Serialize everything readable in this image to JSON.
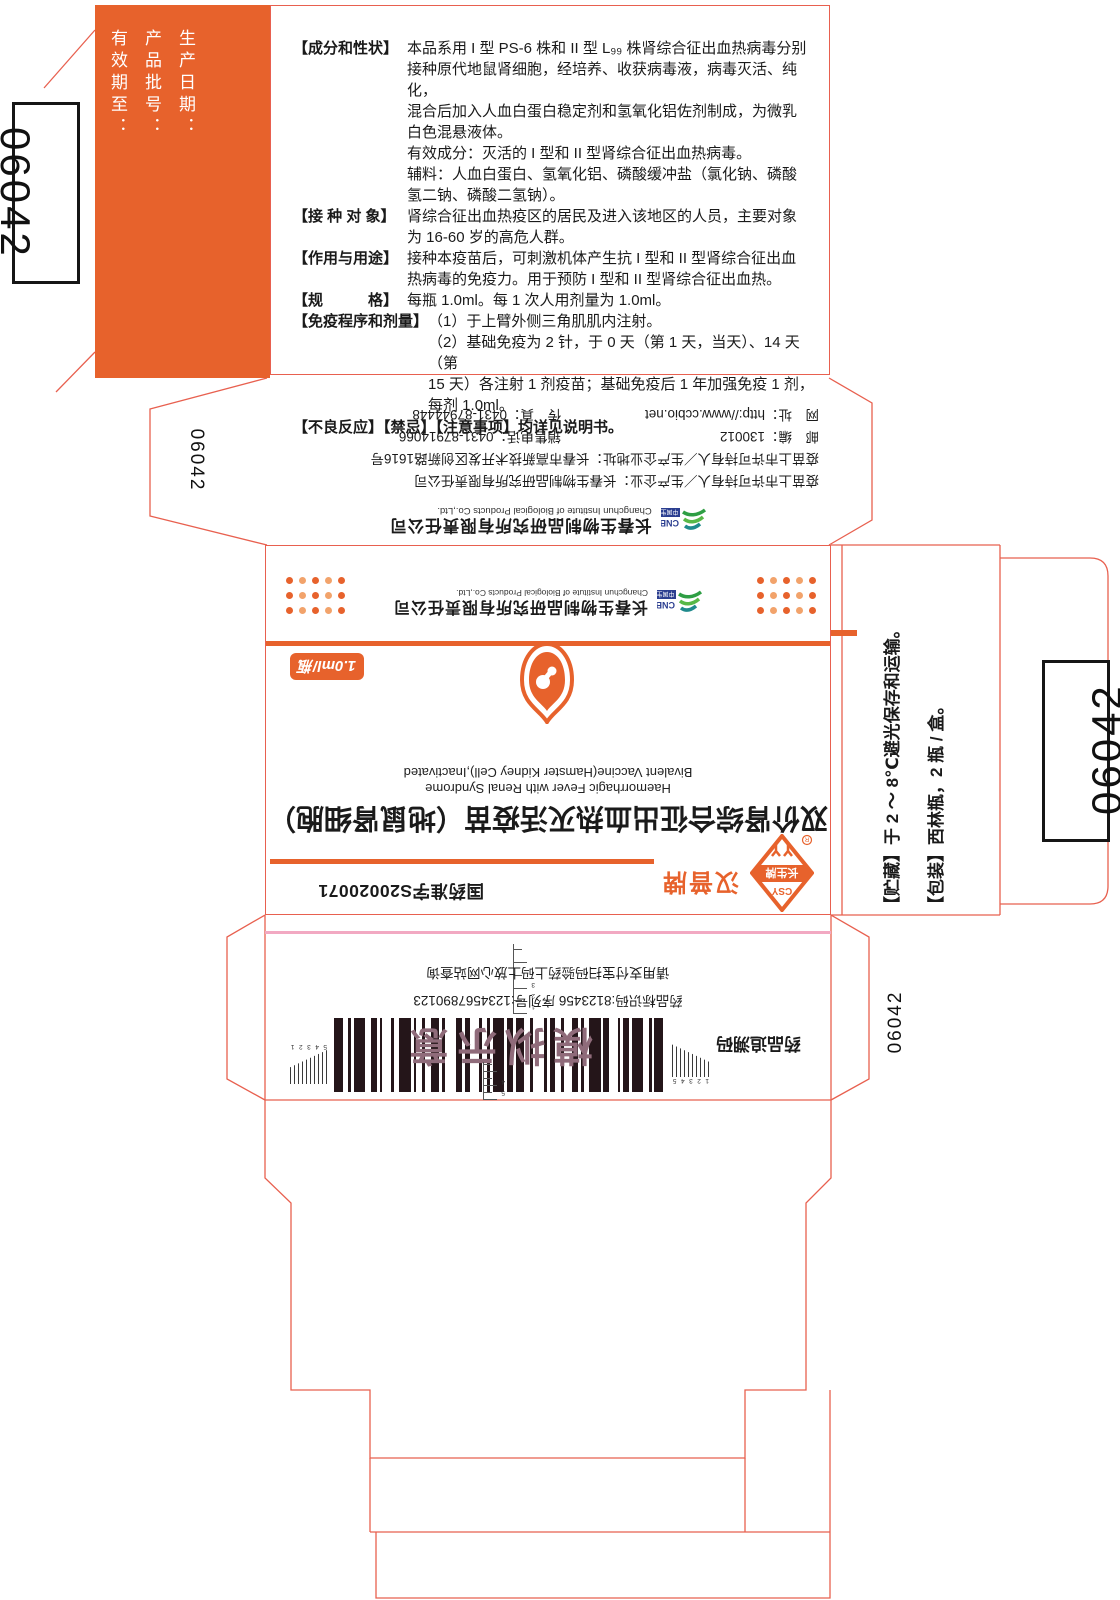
{
  "colors": {
    "orange": "#E7622C",
    "dieline": "#E8604F",
    "pink": "#F2A9C2",
    "mauve": "#8F6B7A",
    "blue": "#2B3E90",
    "green": "#2E9E44"
  },
  "dieline_codes": {
    "left_box": "06042",
    "right_box": "06042",
    "top_flap": "06042",
    "bottom_flap": "06042"
  },
  "batch_panel": {
    "lines": [
      "生产日期：",
      "产品批号：",
      "有效期至："
    ]
  },
  "spec_panel": {
    "sections": [
      {
        "label": "【成分和性状】",
        "text": "本品系用 I 型 PS-6 株和 II 型 L₉₉ 株肾综合征出血热病毒分别\n接种原代地鼠肾细胞，经培养、收获病毒液，病毒灭活、纯化，\n混合后加入人血白蛋白稳定剂和氢氧化铝佐剂制成，为微乳\n白色混悬液体。\n有效成分：灭活的 I 型和 II 型肾综合征出血热病毒。\n辅料：人血白蛋白、氢氧化铝、磷酸缓冲盐（氯化钠、磷酸\n氢二钠、磷酸二氢钠）。"
      },
      {
        "label": "【接 种 对 象】",
        "text": "肾综合征出血热疫区的居民及进入该地区的人员，主要对象\n为 16-60 岁的高危人群。"
      },
      {
        "label": "【作用与用途】",
        "text": "接种本疫苗后，可刺激机体产生抗 I 型和 II 型肾综合征出血\n热病毒的免疫力。用于预防 I 型和 II 型肾综合征出血热。"
      },
      {
        "label": "【规　　　格】",
        "text": "每瓶 1.0ml。每 1 次人用剂量为 1.0ml。"
      },
      {
        "label": "【免疫程序和剂量】",
        "text": "（1）于上臂外侧三角肌肌内注射。\n（2）基础免疫为 2 针，于 0 天（第 1 天，当天）、14 天（第\n15 天）各注射 1 剂疫苗；基础免疫后 1 年加强免疫 1 剂，\n每剂 1.0ml。"
      }
    ],
    "footer": "【不良反应】【禁忌】【注意事项】均详见说明书。"
  },
  "company": {
    "name_cn": "长春生物制品研究所有限责任公司",
    "name_en": "Changchun Institute of Biological Products Co.,Ltd.",
    "holder_line": "疫苗上市许可持有人／生产企业：长春生物制品研究所有限责任公司",
    "address_line": "疫苗上市许可持有人／生产企业地址：长春市高新技术开发区创新路1616号",
    "postcode_line": "邮　编：130012",
    "sales_line": "销售电话：0431-87914066",
    "web_line": "网　址：http://www.ccbio.net",
    "fax_line": "传　真：0431-87944448"
  },
  "main_face": {
    "approval_no": "国药准字S20020071",
    "brand_text": "汉普牌",
    "trademark": {
      "top": "CSY",
      "name": "长生牌",
      "reg": "R"
    },
    "dose_badge": "1.0ml/瓶",
    "product_name_cn": "双价肾综合征出血热灭活疫苗（地鼠肾细胞）",
    "product_name_en_1": "Haemorrhagic Fever with Renal Syndrome",
    "product_name_en_2": "Bivalent Vaccine(Hamster Kidney Cell),Inactivated",
    "cnbg": {
      "abbr": "CNBG",
      "cn": "中国生物"
    }
  },
  "storage_panel": {
    "line1": "【贮藏】于 2 ～ 8℃避光保存和运输。",
    "line2": "【包装】西林瓶，2 瓶 / 盒。"
  },
  "trace_panel": {
    "label": "药品追溯码",
    "overlay": "模拟示意",
    "id_line": "药品标识码:8123456 序列号:1234567890123",
    "hint_line": "请用支付宝扫码验药上码上放心网站查询",
    "scales": {
      "left": "12345",
      "right": "54321",
      "top": "54",
      "bottom": "123"
    }
  }
}
